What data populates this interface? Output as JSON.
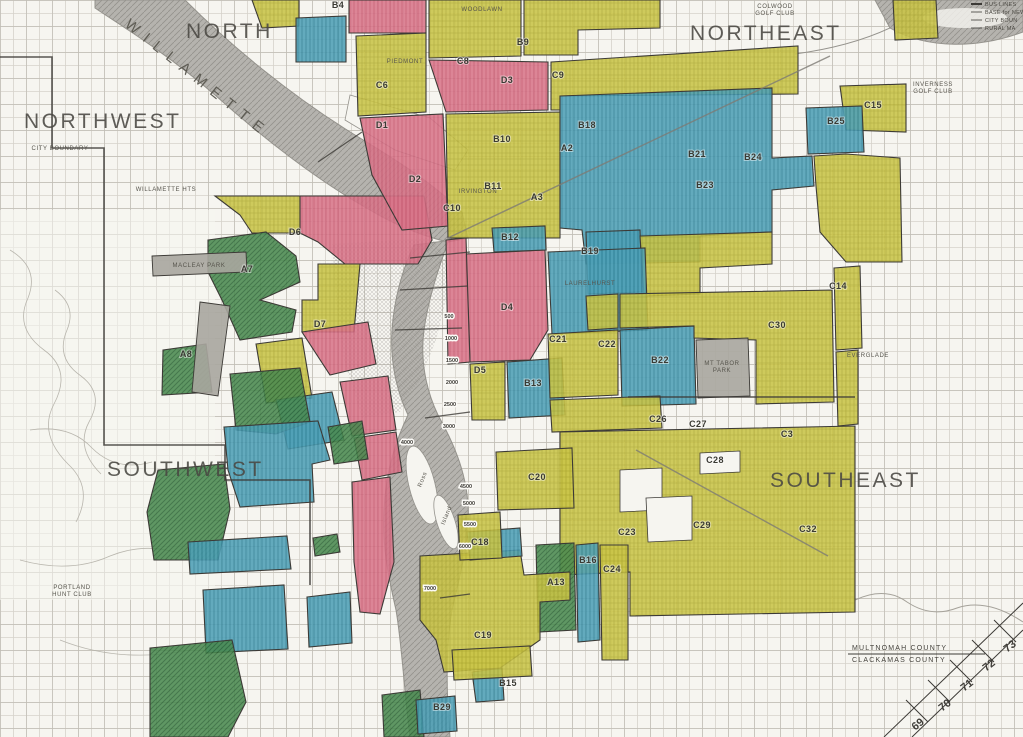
{
  "map": {
    "title": "HOLC residential security map, Portland Oregon",
    "colors": {
      "bg": "#f6f5f0",
      "grid": "#d6d3cb",
      "grid2": "#bebbb2",
      "ink": "#3c3a36",
      "A": "#4a8a50",
      "A_line": "#2d6636",
      "B": "#4fa0b6",
      "B_line": "#2b7c93",
      "C": "#c9c447",
      "C_line": "#a5a028",
      "D": "#d8758a",
      "D_line": "#c05068",
      "river": "#b5b3ae",
      "river_line": "#94928c",
      "park": "#a9a69f"
    },
    "grade_names": {
      "A": "Best",
      "B": "Still Desirable",
      "C": "Definitely Declining",
      "D": "Hazardous"
    },
    "region_labels": [
      {
        "text": "NORTH",
        "x": 186,
        "y": 38
      },
      {
        "text": "NORTHEAST",
        "x": 690,
        "y": 40
      },
      {
        "text": "NORTHWEST",
        "x": 24,
        "y": 128
      },
      {
        "text": "SOUTHWEST",
        "x": 107,
        "y": 476
      },
      {
        "text": "SOUTHEAST",
        "x": 770,
        "y": 487
      }
    ],
    "river_label": {
      "text": "WILLAMETTE",
      "x": 124,
      "y": 26,
      "rotate": 38.5
    },
    "zones": [
      {
        "grade": "C",
        "points": "215,196 300,196 300,233 252,233 240,215"
      },
      {
        "grade": "D",
        "code": "D6",
        "points": "300,196 424,196 432,240 418,264 345,264 318,242 300,233"
      },
      {
        "grade": "C",
        "points": "318,264 360,264 354,332 302,332 302,300 318,300"
      },
      {
        "grade": "D",
        "code": "D7",
        "points": "302,332 368,322 376,364 330,375"
      },
      {
        "grade": "C",
        "points": "256,344 302,338 312,398 266,403"
      },
      {
        "grade": "B",
        "points": "276,400 332,392 344,440 288,449"
      },
      {
        "grade": "D",
        "points": "340,382 388,376 396,430 352,436"
      },
      {
        "grade": "D",
        "points": "354,438 396,432 402,472 362,480"
      },
      {
        "grade": "A",
        "code": "A7",
        "points": "208,240 266,232 296,256 300,282 260,300 296,310 292,332 240,340 222,300 208,272"
      },
      {
        "grade": "A",
        "code": "A8",
        "points": "163,350 206,344 212,392 162,395"
      },
      {
        "grade": "A",
        "points": "230,374 300,368 310,422 276,434 236,430"
      },
      {
        "grade": "A",
        "points": "328,427 362,421 368,459 334,464"
      },
      {
        "grade": "B",
        "points": "224,427 318,421 330,460 312,464 314,502 240,507 228,470"
      },
      {
        "grade": "A",
        "points": "158,470 224,464 230,509 218,560 154,560 147,512"
      },
      {
        "grade": "B",
        "points": "188,542 287,536 291,569 190,574"
      },
      {
        "grade": "B",
        "points": "203,590 284,585 288,649 206,653"
      },
      {
        "grade": "B",
        "points": "307,597 350,592 352,643 309,647"
      },
      {
        "grade": "A",
        "points": "313,538 337,534 340,552 315,556"
      },
      {
        "grade": "D",
        "points": "352,482 390,477 394,562 380,614 360,612 354,562"
      },
      {
        "grade": "A",
        "points": "150,648 232,640 246,702 228,737 150,737"
      },
      {
        "grade": "A",
        "points": "382,695 420,690 424,737 384,737"
      },
      {
        "grade": "B",
        "code": "B29",
        "points": "416,700 455,696 457,731 418,734"
      },
      {
        "grade": "C",
        "points": "252,0 299,0 299,26 262,28"
      },
      {
        "grade": "B",
        "code": "B4",
        "points": "296,18 346,16 346,62 296,62"
      },
      {
        "grade": "D",
        "points": "349,0 426,0 426,33 349,33"
      },
      {
        "grade": "C",
        "points": "429,0 521,0 521,56 429,58"
      },
      {
        "grade": "C",
        "points": "524,0 660,0 660,28 578,30 578,55 524,55"
      },
      {
        "grade": "C",
        "code": "C6",
        "points": "356,36 426,33 426,112 358,116"
      },
      {
        "grade": "D",
        "code": "D1",
        "points": "360,118 443,114 448,226 402,230 372,175"
      },
      {
        "grade": "D",
        "code": "D3",
        "points": "429,60 548,62 548,110 446,112"
      },
      {
        "grade": "C",
        "code": "C10",
        "points": "446,114 560,112 560,238 448,238"
      },
      {
        "grade": "C",
        "code": "C9",
        "points": "551,62 798,46 798,94 560,96 560,110 551,110"
      },
      {
        "grade": "B",
        "code": "B21",
        "points": "560,96 772,88 772,158 812,156 814,186 772,190 772,232 700,236 700,262 586,264 582,230 560,228"
      },
      {
        "grade": "B",
        "code": "B23",
        "points": "586,232 640,230 642,292 588,294"
      },
      {
        "grade": "C",
        "points": "640,236 772,232 772,264 700,268 700,294 644,296"
      },
      {
        "grade": "C",
        "code": "C15",
        "points": "840,86 906,84 906,132 846,130"
      },
      {
        "grade": "B",
        "code": "B25",
        "points": "806,108 862,106 864,152 808,154"
      },
      {
        "grade": "C",
        "points": "814,156 846,154 900,158 902,262 846,262 820,232 816,186"
      },
      {
        "grade": "C",
        "points": "893,0 936,0 938,38 895,40"
      },
      {
        "grade": "D",
        "code": "D4",
        "points": "466,254 545,250 548,330 530,360 470,362"
      },
      {
        "grade": "D",
        "points": "446,240 466,238 470,362 448,364"
      },
      {
        "grade": "B",
        "code": "B12",
        "points": "492,228 545,226 546,250 494,252"
      },
      {
        "grade": "B",
        "code": "B19",
        "points": "548,252 645,248 648,330 552,334"
      },
      {
        "grade": "C",
        "points": "470,364 505,362 505,420 472,420"
      },
      {
        "grade": "B",
        "code": "B13",
        "points": "507,362 562,358 565,415 509,418"
      },
      {
        "grade": "C",
        "code": "C21",
        "points": "548,334 618,330 618,395 550,398"
      },
      {
        "grade": "B",
        "code": "B22",
        "points": "620,330 694,326 696,404 622,406"
      },
      {
        "grade": "C",
        "code": "C30",
        "points": "620,294 832,290 834,402 756,404 756,340 694,338 694,326 620,328"
      },
      {
        "grade": "C",
        "code": "C14",
        "points": "834,268 860,266 862,348 836,350"
      },
      {
        "grade": "C",
        "points": "586,296 618,294 618,328 588,330"
      },
      {
        "grade": "C",
        "points": "550,400 660,396 662,428 552,432"
      },
      {
        "grade": "C",
        "code": "C28",
        "points": "560,432 855,426 855,612 630,616 630,572 560,575"
      },
      {
        "grade": "C",
        "code": "C24",
        "points": "600,545 628,545 628,660 602,660"
      },
      {
        "grade": "B",
        "code": "B16",
        "points": "576,545 598,543 600,640 578,642"
      },
      {
        "grade": "A",
        "code": "A13",
        "points": "536,545 574,543 576,630 538,632"
      },
      {
        "grade": "C",
        "code": "C19",
        "points": "420,556 520,550 524,575 570,572 570,600 540,602 540,640 500,668 444,672 436,640 420,620"
      },
      {
        "grade": "B",
        "points": "467,532 520,528 522,556 470,560"
      },
      {
        "grade": "B",
        "code": "B15",
        "points": "472,672 502,668 504,700 476,702"
      },
      {
        "grade": "C",
        "code": "C20",
        "points": "496,452 572,448 574,508 498,510"
      },
      {
        "grade": "C",
        "code": "C18",
        "points": "458,515 500,512 502,558 460,560"
      },
      {
        "grade": "C",
        "points": "452,650 530,646 532,676 454,680"
      },
      {
        "grade": "C",
        "points": "836,352 858,350 858,424 838,426"
      }
    ],
    "unshaded_holes": [
      {
        "points": "620,470 662,468 662,510 620,512"
      },
      {
        "points": "646,498 692,496 692,540 648,542"
      },
      {
        "points": "700,453 740,451 740,472 700,474"
      }
    ],
    "parks": [
      {
        "name": "Macleay Park",
        "points": "152,256 246,252 247,272 153,276"
      },
      {
        "name": "golf links",
        "points": "200,302 230,306 218,396 192,392"
      },
      {
        "name": "Mt Tabor Park",
        "points": "696,340 748,338 750,396 698,398"
      }
    ],
    "zone_labels": [
      {
        "code": "A2",
        "x": 567,
        "y": 151
      },
      {
        "code": "A3",
        "x": 537,
        "y": 200
      },
      {
        "code": "A7",
        "x": 247,
        "y": 272
      },
      {
        "code": "A8",
        "x": 186,
        "y": 357
      },
      {
        "code": "A13",
        "x": 556,
        "y": 585
      },
      {
        "code": "B4",
        "x": 338,
        "y": 8
      },
      {
        "code": "B9",
        "x": 523,
        "y": 45
      },
      {
        "code": "B10",
        "x": 502,
        "y": 142
      },
      {
        "code": "B11",
        "x": 493,
        "y": 189
      },
      {
        "code": "B12",
        "x": 510,
        "y": 240
      },
      {
        "code": "B13",
        "x": 533,
        "y": 386
      },
      {
        "code": "B15",
        "x": 508,
        "y": 686
      },
      {
        "code": "B16",
        "x": 588,
        "y": 563
      },
      {
        "code": "B18",
        "x": 587,
        "y": 128
      },
      {
        "code": "B19",
        "x": 590,
        "y": 254
      },
      {
        "code": "B21",
        "x": 697,
        "y": 157
      },
      {
        "code": "B22",
        "x": 660,
        "y": 363
      },
      {
        "code": "B23",
        "x": 705,
        "y": 188
      },
      {
        "code": "B24",
        "x": 753,
        "y": 160
      },
      {
        "code": "B25",
        "x": 836,
        "y": 124
      },
      {
        "code": "B29",
        "x": 442,
        "y": 710
      },
      {
        "code": "C3",
        "x": 787,
        "y": 437
      },
      {
        "code": "C6",
        "x": 382,
        "y": 88
      },
      {
        "code": "C8",
        "x": 463,
        "y": 64
      },
      {
        "code": "C9",
        "x": 558,
        "y": 78
      },
      {
        "code": "C10",
        "x": 452,
        "y": 211
      },
      {
        "code": "C14",
        "x": 838,
        "y": 289
      },
      {
        "code": "C15",
        "x": 873,
        "y": 108
      },
      {
        "code": "C18",
        "x": 480,
        "y": 545
      },
      {
        "code": "C19",
        "x": 483,
        "y": 638
      },
      {
        "code": "C20",
        "x": 537,
        "y": 480
      },
      {
        "code": "C21",
        "x": 558,
        "y": 342
      },
      {
        "code": "C22",
        "x": 607,
        "y": 347
      },
      {
        "code": "C23",
        "x": 627,
        "y": 535
      },
      {
        "code": "C24",
        "x": 612,
        "y": 572
      },
      {
        "code": "C26",
        "x": 658,
        "y": 422
      },
      {
        "code": "C27",
        "x": 698,
        "y": 427
      },
      {
        "code": "C28",
        "x": 715,
        "y": 463
      },
      {
        "code": "C29",
        "x": 702,
        "y": 528
      },
      {
        "code": "C30",
        "x": 777,
        "y": 328
      },
      {
        "code": "C32",
        "x": 808,
        "y": 532
      },
      {
        "code": "D1",
        "x": 382,
        "y": 128
      },
      {
        "code": "D2",
        "x": 415,
        "y": 182
      },
      {
        "code": "D3",
        "x": 507,
        "y": 83
      },
      {
        "code": "D4",
        "x": 507,
        "y": 310
      },
      {
        "code": "D5",
        "x": 480,
        "y": 373
      },
      {
        "code": "D6",
        "x": 295,
        "y": 235
      },
      {
        "code": "D7",
        "x": 320,
        "y": 327
      }
    ],
    "place_labels": [
      {
        "text": "COLWOOD",
        "x": 775,
        "y": 8
      },
      {
        "text": "GOLF CLUB",
        "x": 775,
        "y": 15
      },
      {
        "text": "INVERNESS",
        "x": 933,
        "y": 86
      },
      {
        "text": "GOLF CLUB",
        "x": 933,
        "y": 93
      },
      {
        "text": "PORTLAND",
        "x": 72,
        "y": 589
      },
      {
        "text": "HUNT CLUB",
        "x": 72,
        "y": 596
      },
      {
        "text": "MACLEAY PARK",
        "x": 199,
        "y": 267
      },
      {
        "text": "MT TABOR",
        "x": 722,
        "y": 365
      },
      {
        "text": "PARK",
        "x": 722,
        "y": 372
      },
      {
        "text": "PIEDMONT",
        "x": 405,
        "y": 63
      },
      {
        "text": "WOODLAWN",
        "x": 482,
        "y": 11
      },
      {
        "text": "IRVINGTON",
        "x": 478,
        "y": 193
      },
      {
        "text": "LAURELHURST",
        "x": 590,
        "y": 285
      },
      {
        "text": "EVERGLADE",
        "x": 868,
        "y": 357
      },
      {
        "text": "WILLAMETTE HTS",
        "x": 166,
        "y": 191
      },
      {
        "text": "CITY BOUNDARY",
        "x": 60,
        "y": 150
      },
      {
        "text": "Ross",
        "x": 424,
        "y": 480,
        "rotate": -68
      },
      {
        "text": "Island",
        "x": 448,
        "y": 516,
        "rotate": -68
      }
    ],
    "block_numbers": [
      {
        "text": "500",
        "x": 449,
        "y": 318
      },
      {
        "text": "1000",
        "x": 451,
        "y": 340
      },
      {
        "text": "1500",
        "x": 452,
        "y": 362
      },
      {
        "text": "2000",
        "x": 452,
        "y": 384
      },
      {
        "text": "2500",
        "x": 450,
        "y": 406
      },
      {
        "text": "3000",
        "x": 449,
        "y": 428
      },
      {
        "text": "4000",
        "x": 407,
        "y": 444
      },
      {
        "text": "4500",
        "x": 466,
        "y": 488
      },
      {
        "text": "5000",
        "x": 469,
        "y": 505
      },
      {
        "text": "5500",
        "x": 470,
        "y": 526
      },
      {
        "text": "6000",
        "x": 465,
        "y": 548
      },
      {
        "text": "7000",
        "x": 430,
        "y": 590
      }
    ],
    "county_line": {
      "upper": "MULTNOMAH   COUNTY",
      "lower": "CLACKAMAS   COUNTY",
      "x": 852,
      "y_upper": 650,
      "y_lower": 662
    },
    "sheet_index": {
      "numbers": [
        "69",
        "70",
        "71",
        "72",
        "73"
      ],
      "positions": [
        {
          "x": 920,
          "y": 727
        },
        {
          "x": 947,
          "y": 708
        },
        {
          "x": 969,
          "y": 688
        },
        {
          "x": 991,
          "y": 668
        },
        {
          "x": 1012,
          "y": 649
        }
      ],
      "rotate": -38
    },
    "legend_fragment": {
      "items": [
        "BUS LINES",
        "BASE for NEW",
        "CITY BOUN",
        "RURAL MA"
      ],
      "x": 985,
      "y_start": 6,
      "row_h": 8
    }
  }
}
